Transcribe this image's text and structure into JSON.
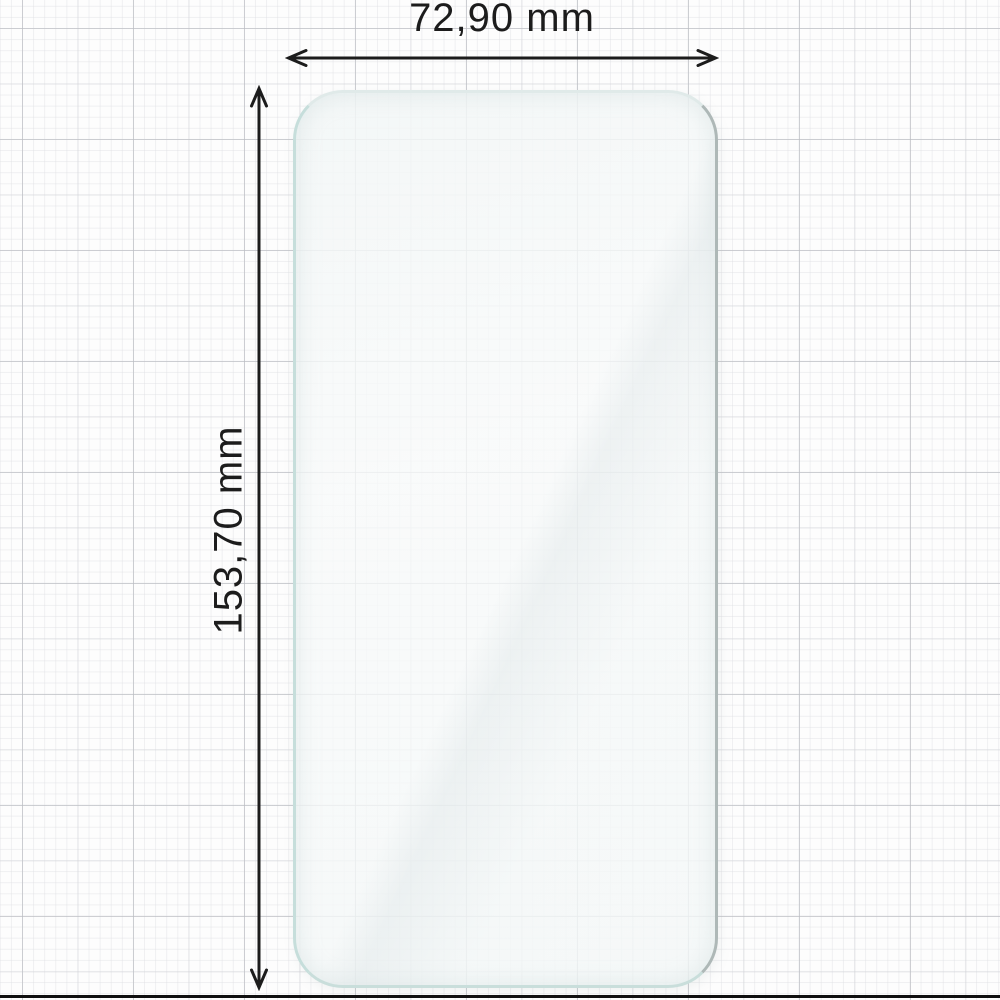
{
  "dimensions": {
    "width_label": "72,90 mm",
    "height_label": "153,70 mm"
  },
  "colors": {
    "annotation": "#1c1c1c",
    "glass_edge_teal": "#c6dedb",
    "glass_edge_gray": "#aeb8b7",
    "glass_fill": "#f4f7f7",
    "grid_minor": "#e5e6ea",
    "grid_major": "#c4c6cb",
    "paper": "#fdfdfd",
    "photo_edge": "#101010"
  }
}
